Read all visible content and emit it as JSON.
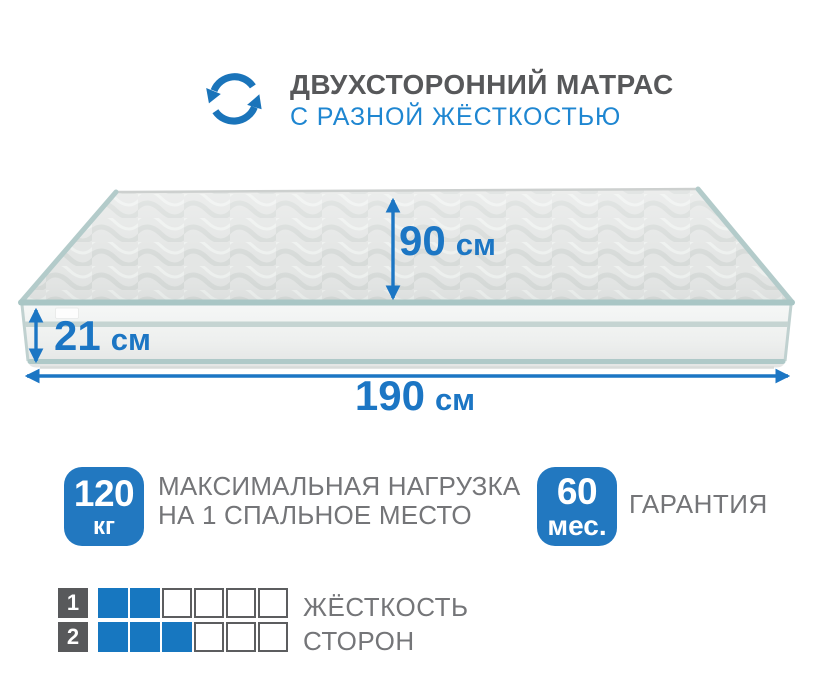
{
  "colors": {
    "accent_blue": "#1c76c4",
    "badge_blue": "#2278c0",
    "subtitle_blue": "#1e86d1",
    "title_gray": "#57585a",
    "text_gray": "#747578",
    "square_dark": "#58595b",
    "piping_teal": "#a9c6c5"
  },
  "header": {
    "icon": "rotate-arrows-icon",
    "title": "ДВУХСТОРОННИЙ МАТРАС",
    "subtitle": "С РАЗНОЙ ЖЁСТКОСТЬЮ"
  },
  "mattress": {
    "illustration": "two-sided mattress, quilted top, striped side border",
    "width": {
      "value": "90",
      "unit": "см"
    },
    "height": {
      "value": "21",
      "unit": "см"
    },
    "length": {
      "value": "190",
      "unit": "см"
    }
  },
  "badges": [
    {
      "value": "120",
      "unit": "кг",
      "label_line1": "МАКСИМАЛЬНАЯ НАГРУЗКА",
      "label_line2": "НА 1 СПАЛЬНОЕ МЕСТО"
    },
    {
      "value": "60",
      "unit": "мес.",
      "label_line1": "ГАРАНТИЯ"
    }
  ],
  "firmness": {
    "rows": [
      {
        "side": "1",
        "filled": 2,
        "total": 6
      },
      {
        "side": "2",
        "filled": 3,
        "total": 6
      }
    ],
    "label_line1": "ЖЁСТКОСТЬ",
    "label_line2": "СТОРОН"
  }
}
